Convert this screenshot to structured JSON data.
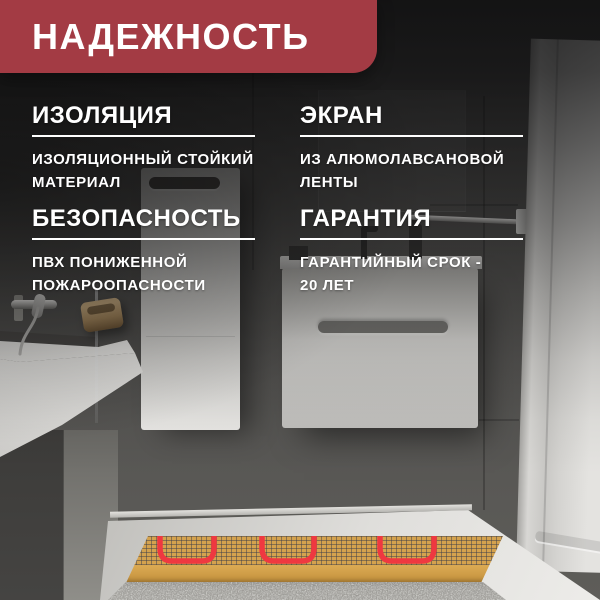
{
  "banner": {
    "title": "НАДЕЖНОСТЬ"
  },
  "features": [
    {
      "title": "ИЗОЛЯЦИЯ",
      "lines": [
        "ИЗОЛЯЦИОННЫЙ СТОЙКИЙ",
        "МАТЕРИАЛ"
      ]
    },
    {
      "title": "ЭКРАН",
      "lines": [
        "ИЗ АЛЮМОЛАВСАНОВОЙ",
        "ЛЕНТЫ"
      ]
    },
    {
      "title": "БЕЗОПАСНОСТЬ",
      "lines": [
        "ПВХ ПОНИЖЕННОЙ",
        "ПОЖАРООПАСНОСТИ"
      ]
    },
    {
      "title": "ГАРАНТИЯ",
      "lines": [
        "ГАРАНТИЙНЫЙ СРОК -",
        "20 ЛЕТ"
      ]
    }
  ],
  "theme": {
    "banner_bg": "#A33B44",
    "text_color": "#FFFFFF",
    "underline_color": "#FFFFFF",
    "mat_color": "#D4A24E",
    "cable_color": "#EF3840",
    "floor_color": "#A6A5A1"
  }
}
